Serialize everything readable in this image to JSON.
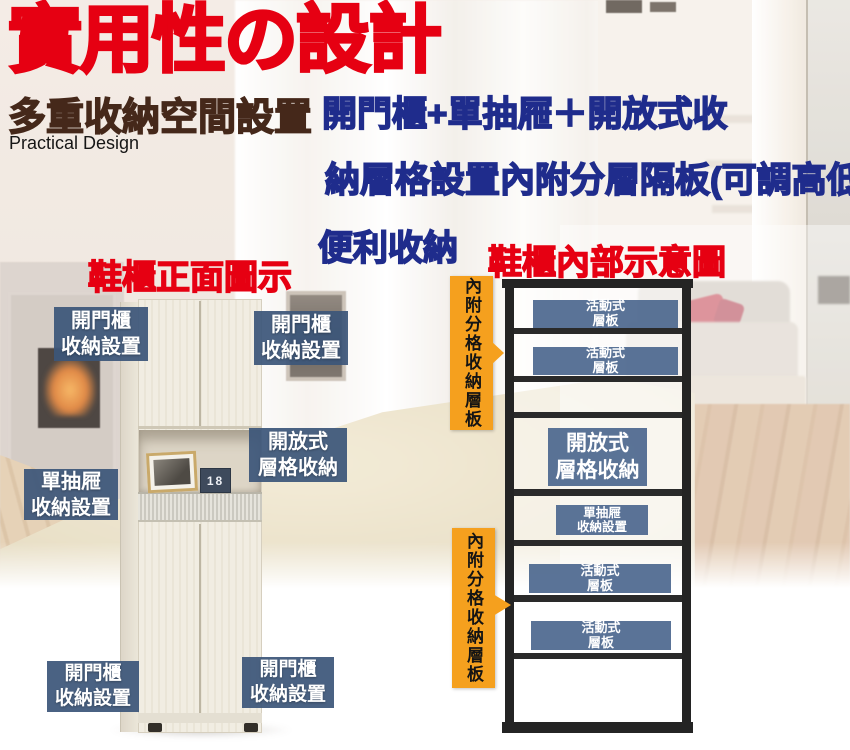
{
  "header": {
    "title": "實用性の設計",
    "subtitle": "多重收納空間設置",
    "subtitle_en": "Practical Design",
    "description_line1": "開門櫃+單抽屜＋開放式收",
    "description_line2": "納層格設置內附分層隔板(可調高低)",
    "description_line3": "便利收納"
  },
  "sections": {
    "front_view_heading": "鞋櫃正面圖示",
    "inner_view_heading": "鞋櫃內部示意圖"
  },
  "front_labels": [
    {
      "id": "door-top-left",
      "text": "開門櫃\n收納設置"
    },
    {
      "id": "door-top-right",
      "text": "開門櫃\n收納設置"
    },
    {
      "id": "open-shelf",
      "text": "開放式\n層格收納"
    },
    {
      "id": "single-drawer",
      "text": "單抽屜\n收納設置"
    },
    {
      "id": "door-bottom-left",
      "text": "開門櫃\n收納設置"
    },
    {
      "id": "door-bottom-right",
      "text": "開門櫃\n收納設置"
    }
  ],
  "side_banners": [
    {
      "id": "upper",
      "text": "內附分格收納層板"
    },
    {
      "id": "lower",
      "text": "內附分格收納層板"
    }
  ],
  "diagram_labels": [
    {
      "id": "movable-shelf-1",
      "text": "活動式\n層板"
    },
    {
      "id": "movable-shelf-2",
      "text": "活動式\n層板"
    },
    {
      "id": "open-shelf",
      "text": "開放式\n層格收納"
    },
    {
      "id": "single-drawer",
      "text": "單抽屜\n收納設置"
    },
    {
      "id": "movable-shelf-3",
      "text": "活動式\n層板"
    },
    {
      "id": "movable-shelf-4",
      "text": "活動式\n層板"
    }
  ],
  "cabinet": {
    "calendar_day": "18"
  },
  "colors": {
    "title_red": "#E60012",
    "subtitle_brown": "#45281A",
    "description_navy": "#1F2C8C",
    "label_blue": "#3C567A",
    "diagram_label_blue": "#486483",
    "banner_orange": "#F5A01E",
    "diagram_frame_black": "#242424"
  }
}
